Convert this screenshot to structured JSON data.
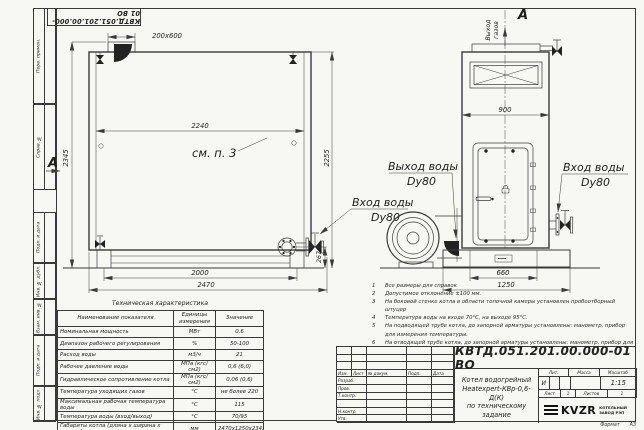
{
  "doc_number": "КВТД.051.201.00.000-01 ВО",
  "margin": {
    "labels": [
      "Перв. примен.",
      "Справ. №",
      "Подп. и дата",
      "Инв. № дубл.",
      "Взам. инв. №",
      "Подп. и дата",
      "Инв. № подл."
    ]
  },
  "front_view": {
    "flue_dim": "200x600",
    "width_inner": "2240",
    "height_total": "2345",
    "height_body": "2255",
    "legs_span": "2000",
    "length_total": "2470",
    "inlet_height": "267",
    "see_note": "см. п. 3",
    "view_label": "А",
    "inlet_line1": "Вход воды",
    "inlet_line2": "Dy80"
  },
  "side_view": {
    "view_label": "А",
    "gas_outlet_line1": "Выход",
    "gas_outlet_line2": "газов",
    "width": "900",
    "base_inner": "660",
    "base_total": "1250",
    "outlet_line1": "Выход воды",
    "outlet_line2": "Dy80",
    "inlet_line1": "Вход воды",
    "inlet_line2": "Dy80"
  },
  "tech_table": {
    "title": "Техническая характеристика",
    "headers": [
      "Наименование показателя",
      "Единицы измерения",
      "Значение"
    ],
    "rows": [
      {
        "name": "Номинальная мощность",
        "unit": "МВт",
        "value": "0,6"
      },
      {
        "name": "Диапазон рабочего регулирования",
        "unit": "%",
        "value": "50-100"
      },
      {
        "name": "Расход воды",
        "unit": "м3/ч",
        "value": "21"
      },
      {
        "name": "Рабочее давление воды",
        "unit": "МПа (кгс/см2)",
        "value": "0,6 (6,0)"
      },
      {
        "name": "Гидравлическое сопротивление котла",
        "unit": "МПа (кгс/см2)",
        "value": "0,06 (0,6)"
      },
      {
        "name": "Температура уходящих газов",
        "unit": "°С",
        "value": "не более 220"
      },
      {
        "name": "Максимальная рабочая температура воды",
        "unit": "°С",
        "value": "115"
      },
      {
        "name": "Температура воды (вход/выход)",
        "unit": "°С",
        "value": "70/95"
      },
      {
        "name": "Габариты котла (длина х ширина х высота)",
        "unit": "мм",
        "value": "2470х1250х2345"
      }
    ]
  },
  "notes": {
    "items": [
      {
        "num": "1",
        "text": "Все размеры для справок"
      },
      {
        "num": "2",
        "text": "Допустимое отклонение ±100 мм."
      },
      {
        "num": "3",
        "text": "На боковой стенке котла в области топочной камеры установлен пробоотборный штуцер"
      },
      {
        "num": "4",
        "text": "Температура воды на входе 70°С, на выходе 95°С."
      },
      {
        "num": "5",
        "text": "На подводящей трубе котла, до запорной арматуры установлены: манометр, прибор для измерения температуры."
      },
      {
        "num": "6",
        "text": "На отводящей трубе котла, до запорной арматуры установлены: манометр, прибор для измерения температуры, предохранительный клапан Dу не менее 40 мм и вывод с обратным клапаном Dу не менее 50 мм."
      },
      {
        "num": "7",
        "text": "Остальные технические требования по ОСТ 108.030.133-84."
      }
    ]
  },
  "title_block": {
    "col_headers": [
      "Изм.",
      "Лист",
      "№ докум.",
      "Подп.",
      "Дата"
    ],
    "row_labels": [
      "Разраб.",
      "Пров.",
      "Т.контр.",
      "",
      "Н.контр.",
      "Утв."
    ],
    "title_line1": "Котел водогрейный",
    "title_line2": "Heatexpert-КВр-0,6-Д(К)",
    "title_line3": "по техническому задание",
    "lit_header": "Лит.",
    "mass_header": "Масса",
    "scale_header": "Масштаб",
    "lit_value": "И",
    "scale_value": "1:15",
    "sheet_label": "Лист",
    "sheet_value": "1",
    "sheets_label": "Листов",
    "sheets_value": "1",
    "logo_text": "KVZR",
    "logo_caption_line1": "КОТЕЛЬНЫЙ",
    "logo_caption_line2": "ЗАВОД РЭП",
    "format_label": "Формат",
    "format_value": "А3"
  }
}
